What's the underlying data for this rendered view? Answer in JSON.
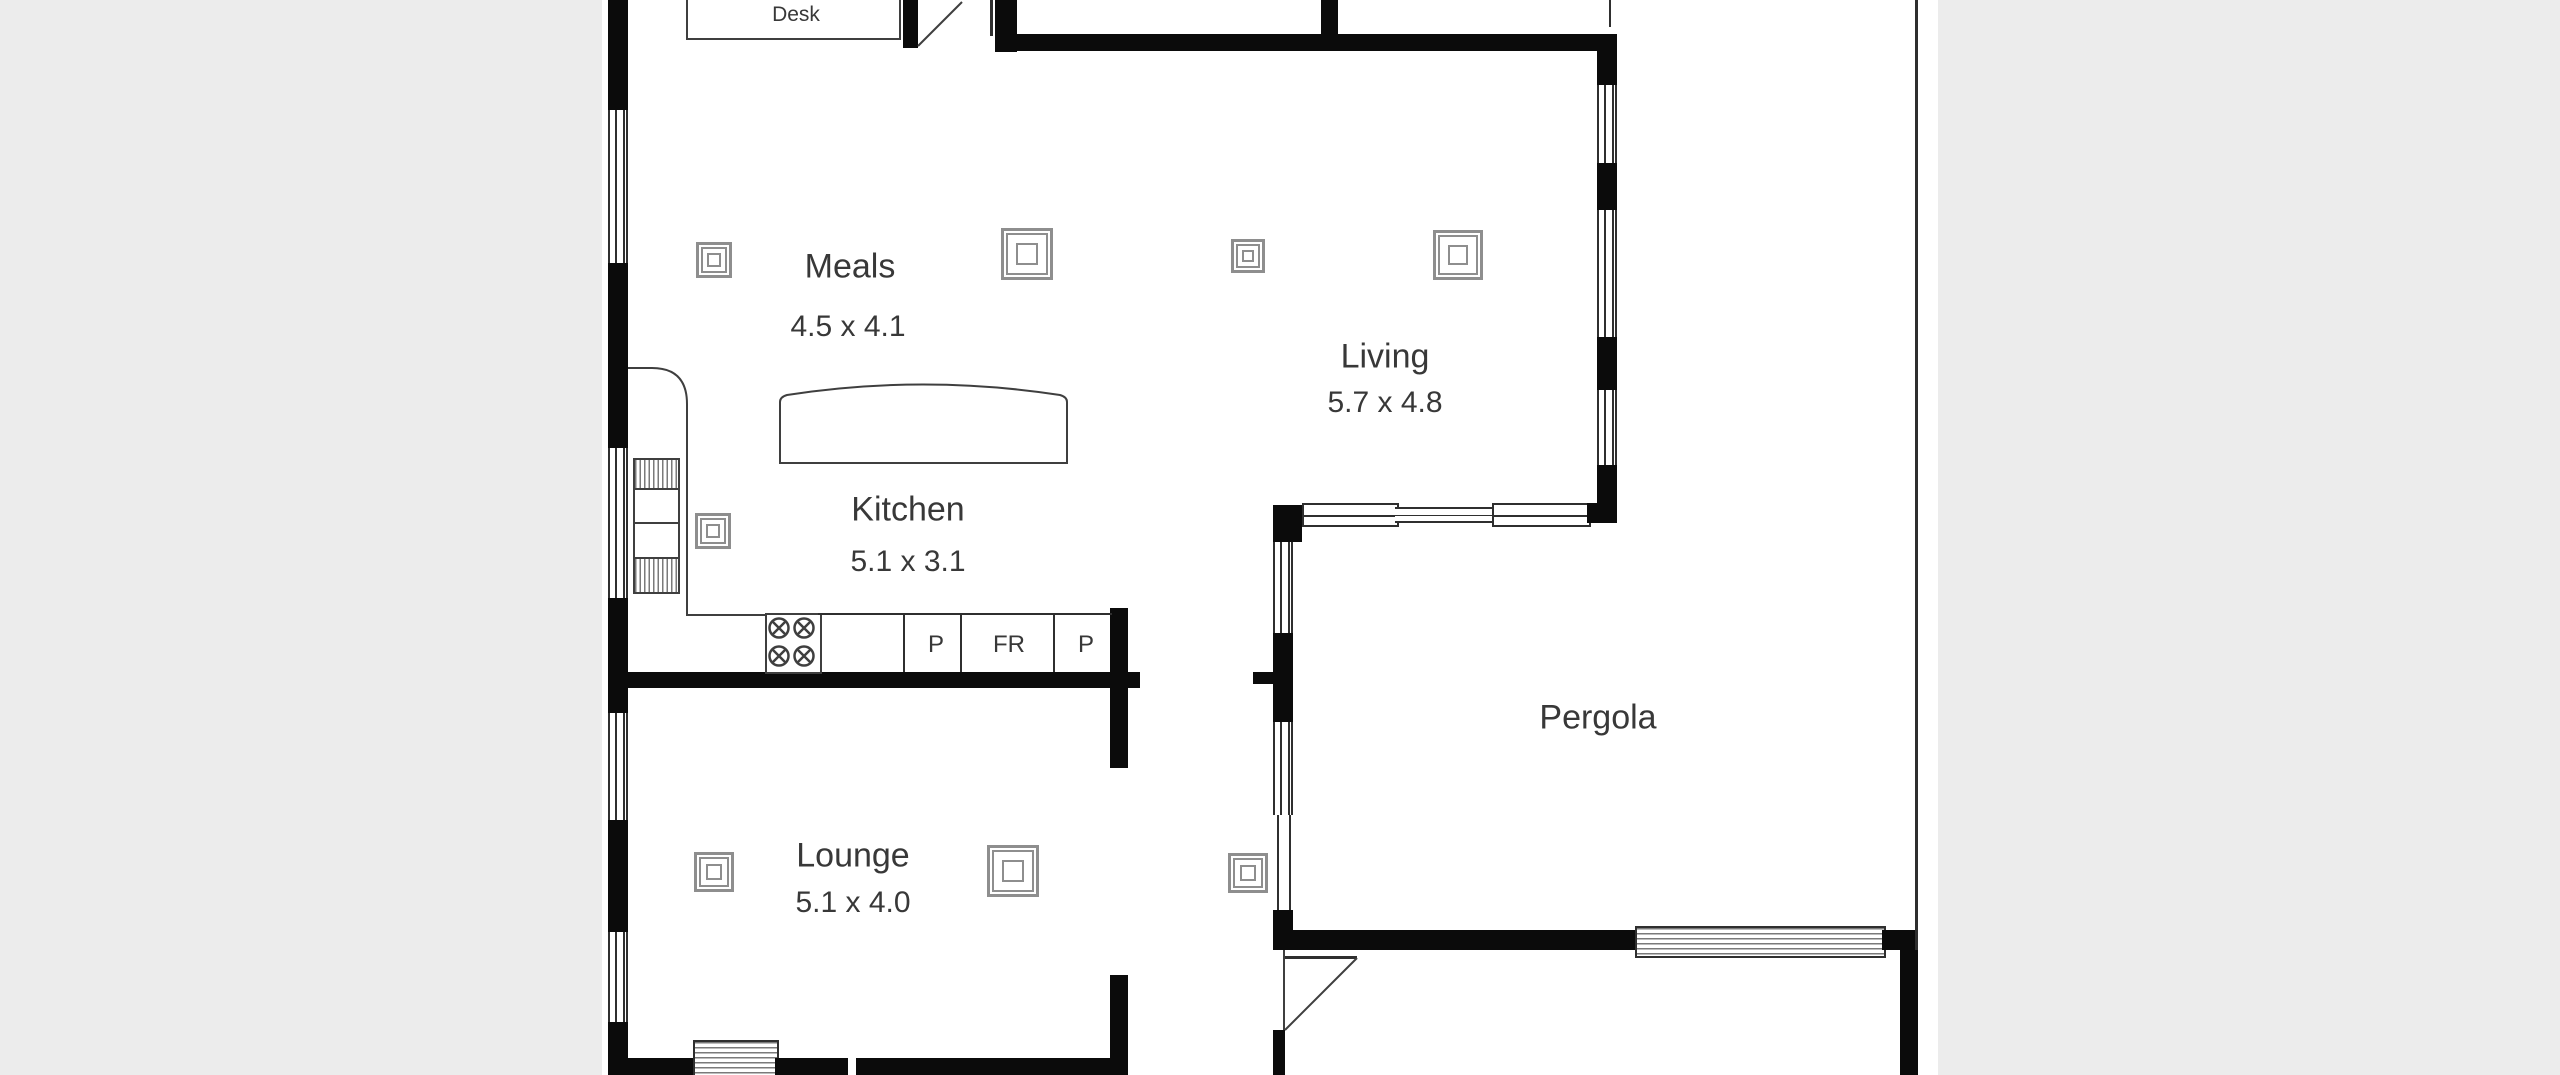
{
  "rooms": [
    {
      "id": "desk",
      "label": "Desk",
      "dims": ""
    },
    {
      "id": "meals",
      "label": "Meals",
      "dims": "4.5 x 4.1"
    },
    {
      "id": "living",
      "label": "Living",
      "dims": "5.7 x 4.8"
    },
    {
      "id": "kitchen",
      "label": "Kitchen",
      "dims": "5.1 x 3.1"
    },
    {
      "id": "lounge",
      "label": "Lounge",
      "dims": "5.1 x 4.0"
    },
    {
      "id": "pergola",
      "label": "Pergola",
      "dims": ""
    }
  ],
  "kitchen_fixtures": [
    {
      "id": "pantry-left",
      "label": "P"
    },
    {
      "id": "fridge",
      "label": "FR"
    },
    {
      "id": "pantry-right",
      "label": "P"
    }
  ],
  "symbols": {
    "ceiling_light": "ceiling-light-icon",
    "ceiling_light_count": 8
  },
  "colors": {
    "wall": "#0b0b0b",
    "thin_line": "#2f2f2f",
    "text": "#383838",
    "paper": "#ffffff",
    "margin": "#ececec",
    "light_symbol": "#8e8e8e"
  }
}
